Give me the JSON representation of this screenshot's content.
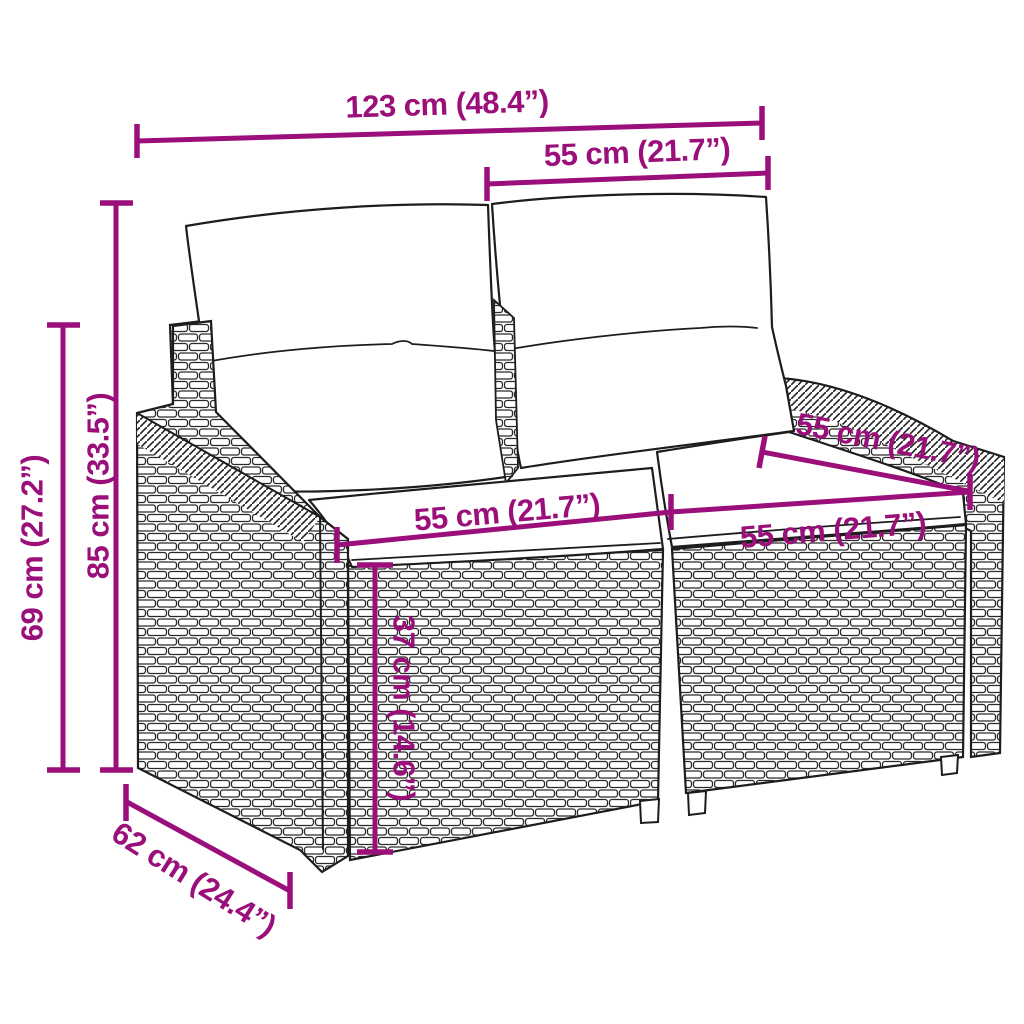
{
  "figure": {
    "subject": "Poly rattan garden bench with cushions — dimension diagram",
    "background_color": "#ffffff",
    "accent_color": "#9b0f7a",
    "outline_color": "#1d1d1d"
  },
  "dimensions": {
    "overall_width": "123 cm (48.4”)",
    "backrest_width": "55 cm (21.7”)",
    "total_height": "85 cm (33.5”)",
    "armrest_height": "69 cm (27.2”)",
    "seat_width_left": "55 cm (21.7”)",
    "seat_width_right": "55 cm (21.7”)",
    "seat_depth_top": "55 cm (21.7”)",
    "seat_height": "37 cm (14.6”)",
    "overall_depth": "62 cm (24.4”)"
  }
}
